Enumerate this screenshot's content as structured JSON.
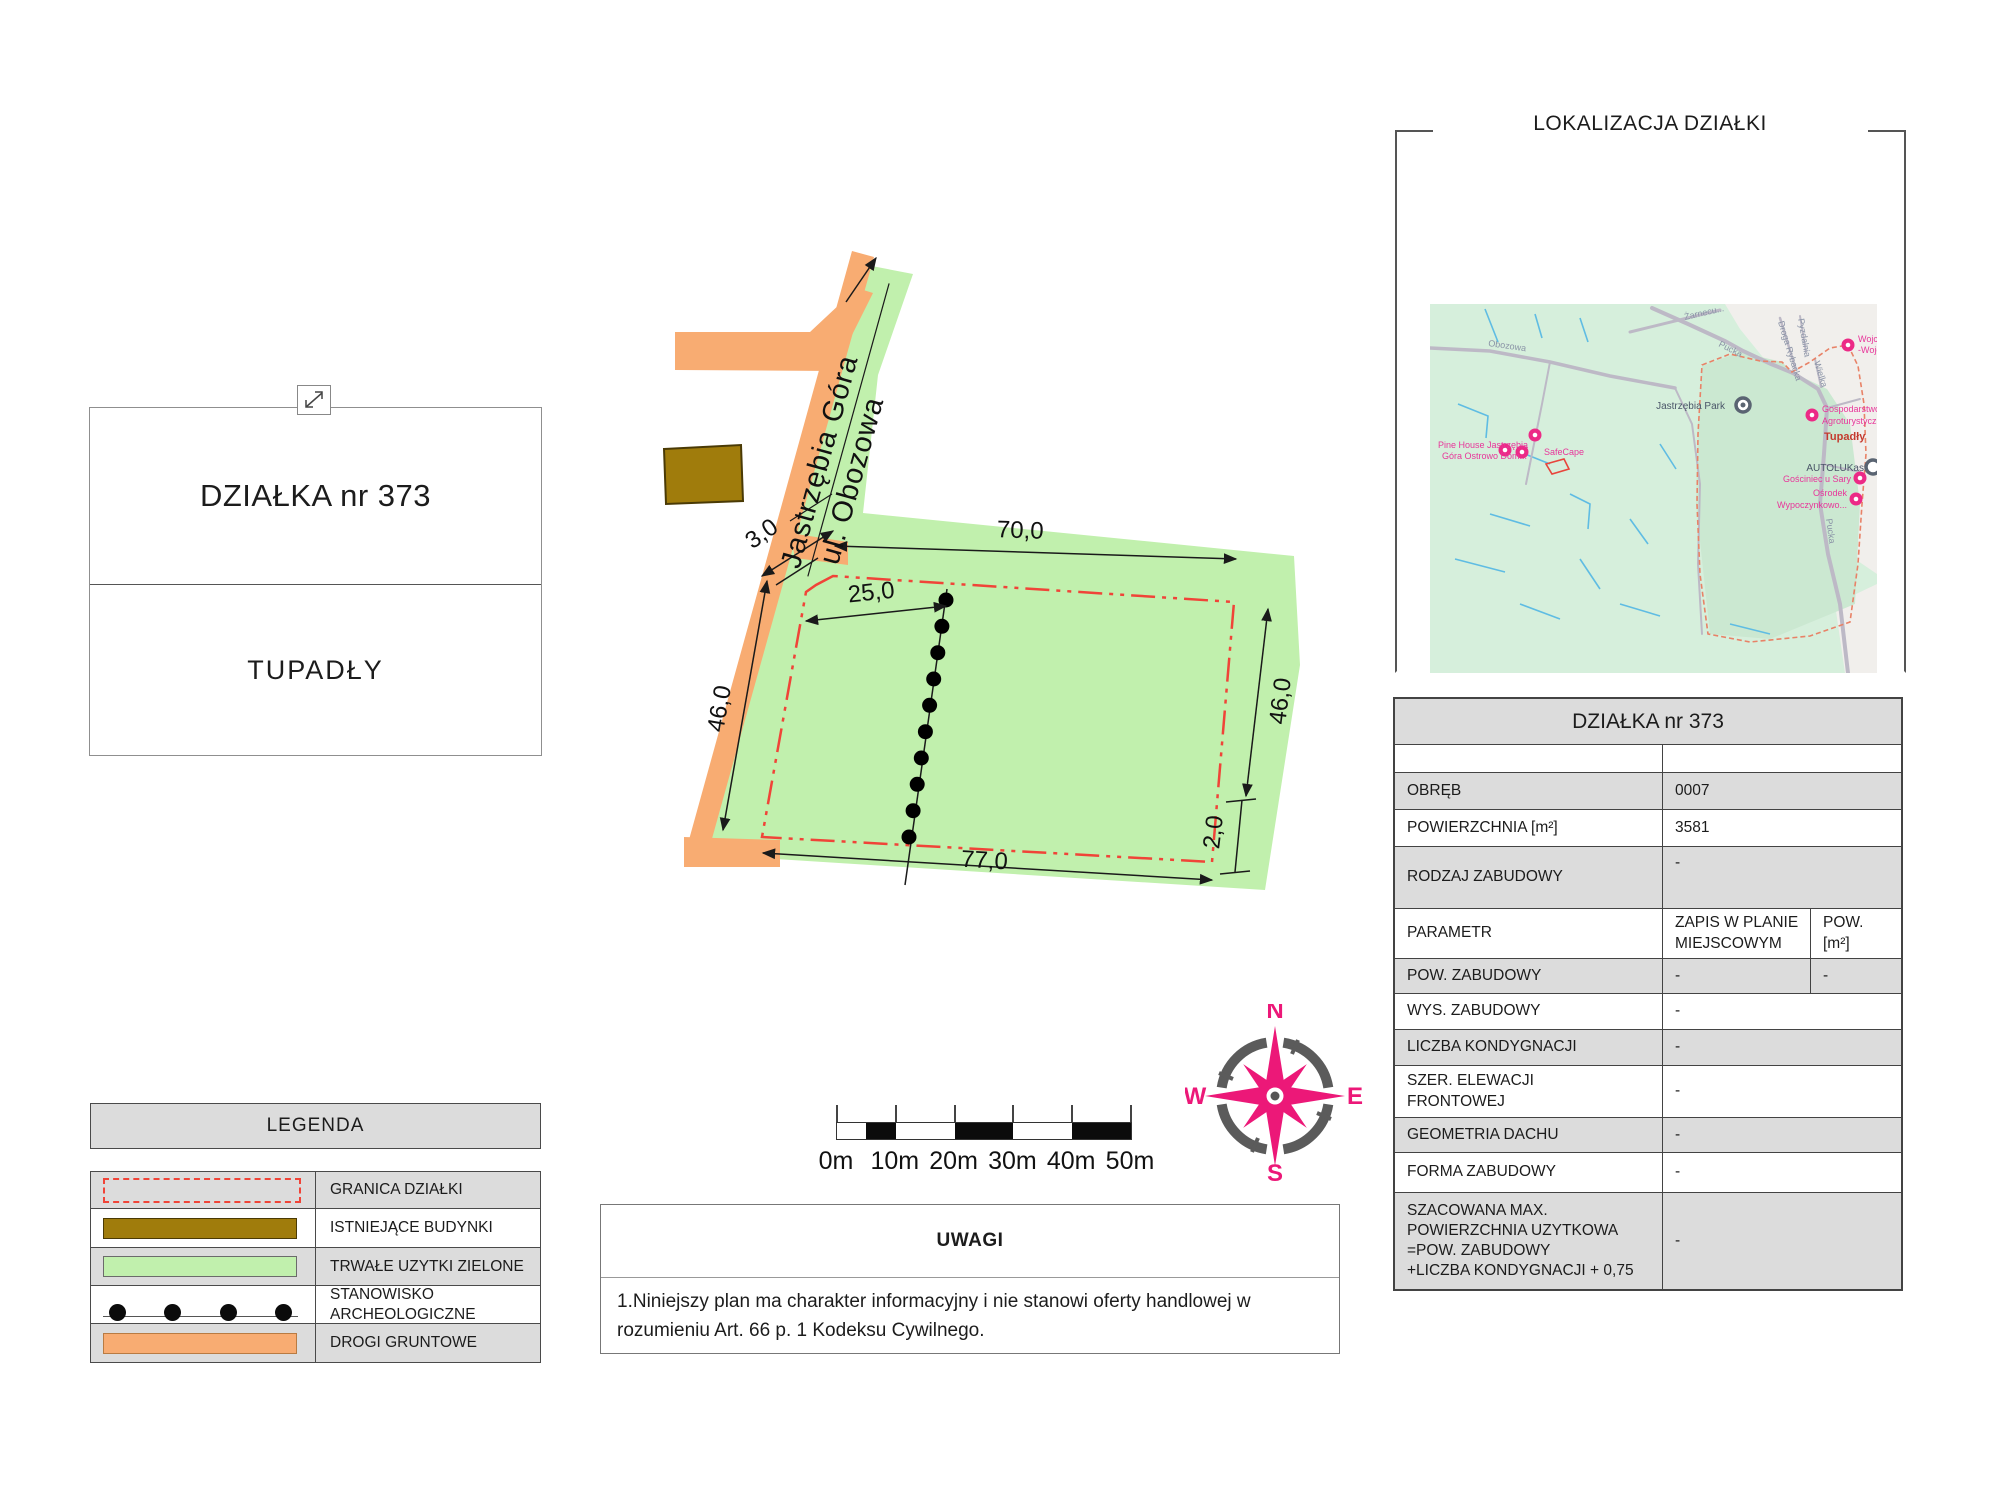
{
  "left_panel": {
    "parcel_title": "DZIAŁKA nr 373",
    "locality": "TUPADŁY"
  },
  "legend": {
    "header": "LEGENDA",
    "rows": [
      {
        "label": "GRANICA DZIAŁKI",
        "type": "boundary"
      },
      {
        "label": "ISTNIEJĄCE BUDYNKI",
        "type": "building"
      },
      {
        "label": "TRWAŁE UZYTKI ZIELONE",
        "type": "green"
      },
      {
        "label": "STANOWISKO ARCHEOLOGICZNE",
        "type": "archaeo"
      },
      {
        "label": "DROGI GRUNTOWE",
        "type": "road"
      }
    ]
  },
  "plan": {
    "road_name_line1": "Jastrzębia Góra",
    "road_name_line2": "ul. Obozowa",
    "dims": {
      "top": "70,0",
      "inner": "25,0",
      "left": "46,0",
      "right": "46,0",
      "right_small": "2,0",
      "bottom": "77,0",
      "road": "3,0"
    }
  },
  "scale_bar": {
    "labels": [
      "0m",
      "10m",
      "20m",
      "30m",
      "40m",
      "50m"
    ]
  },
  "compass": {
    "n": "N",
    "e": "E",
    "s": "S",
    "w": "W"
  },
  "location": {
    "title": "LOKALIZACJA DZIAŁKI",
    "map_labels": {
      "obozowa": "Obozowa",
      "zarnecu": "Żarnecu...",
      "pucka1": "Pucka",
      "pucka2": "Pucka",
      "rybacka": "Droga Rybacka",
      "pyzdalnia": "Pyzdalnia",
      "wielka": "Wielka",
      "park": "Jastrzębia Park",
      "tupadly": "Tupadły",
      "pine1": "Pine House Jastrzębia",
      "pine2": "Góra Ostrowo Dom...",
      "safecape": "SafeCape",
      "wojcie1": "Wojcie...",
      "wojcie2": "-Wojcie...",
      "gosp1": "Gospodarstwo",
      "gosp2": "Agroturystyczne W...",
      "gosciniec": "Gościniec u Sary",
      "autolukas": "AUTOLUKas",
      "osrodek1": "Ośrodek",
      "osrodek2": "Wypoczynkowo..."
    }
  },
  "details_table": {
    "header": "DZIAŁKA nr 373",
    "rows": [
      {
        "label": "",
        "value": ""
      },
      {
        "label": "OBRĘB",
        "value": "0007"
      },
      {
        "label": "POWIERZCHNIA [m²]",
        "value": "3581"
      },
      {
        "label": "RODZAJ ZABUDOWY",
        "value": "-"
      },
      {
        "label": "PARAMETR",
        "value": "ZAPIS W PLANIE MIEJSCOWYM",
        "value2": "POW. [m²]"
      },
      {
        "label": "POW. ZABUDOWY",
        "value": "-",
        "value2": "-"
      },
      {
        "label": "WYS. ZABUDOWY",
        "value": "-"
      },
      {
        "label": "LICZBA KONDYGNACJI",
        "value": "-"
      },
      {
        "label": "SZER. ELEWACJI\nFRONTOWEJ",
        "value": "-"
      },
      {
        "label": "GEOMETRIA DACHU",
        "value": "-"
      },
      {
        "label": "FORMA ZABUDOWY",
        "value": "-"
      },
      {
        "label": "SZACOWANA MAX.\nPOWIERZCHNIA UZYTKOWA\n=POW. ZABUDOWY\n+LICZBA KONDYGNACJI + 0,75",
        "value": "-"
      }
    ]
  },
  "notes": {
    "header": "UWAGI",
    "body": "1.Niniejszy plan ma charakter informacyjny i nie stanowi oferty handlowej w rozumieniu Art. 66 p. 1 Kodeksu Cywilnego."
  },
  "colors": {
    "parcel_green": "#C1F0AD",
    "road_orange": "#F8AC72",
    "building_brown": "#A07C0C",
    "boundary_red": "#F04438",
    "table_gray": "#DCDCDC",
    "map_mint": "#D6EFDC",
    "accent_pink": "#EC1878"
  }
}
